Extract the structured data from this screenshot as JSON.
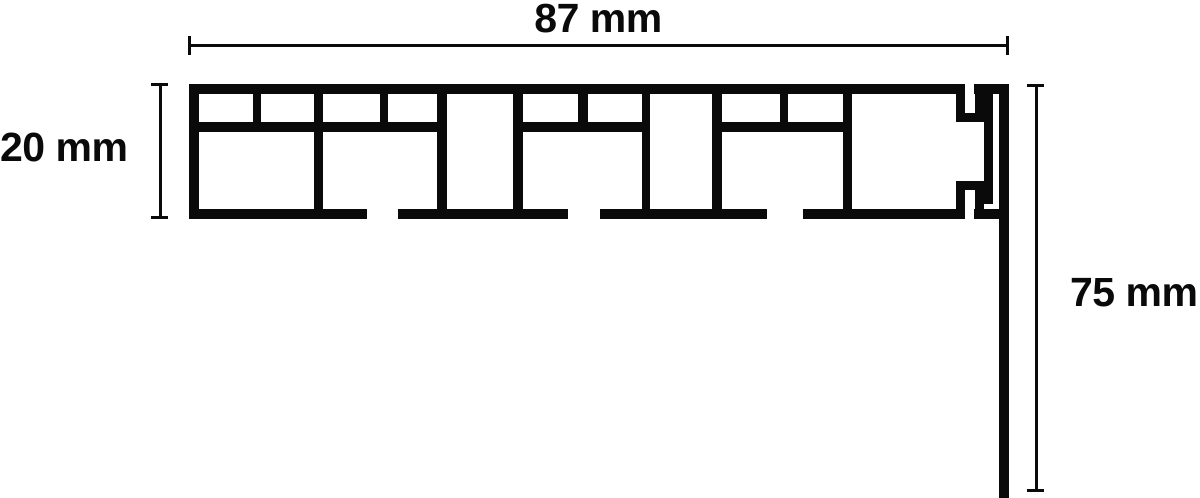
{
  "diagram": {
    "dimension_labels": {
      "width": "87 mm",
      "height": "20 mm",
      "drop": "75 mm"
    },
    "colors": {
      "line": "#0a0a0a",
      "background": "#ffffff"
    }
  }
}
